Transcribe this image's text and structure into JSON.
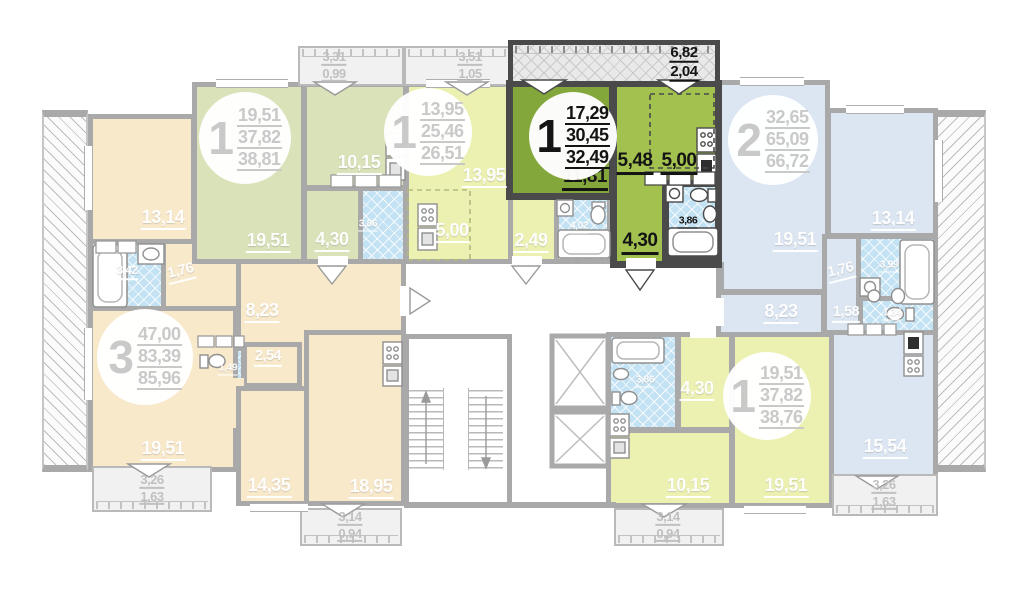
{
  "colors": {
    "selected_fill_dark": "#84a73c",
    "selected_fill_light": "#a3c14f",
    "selected_wall": "#4a4a4a",
    "wall": "#a9a9a9",
    "orange_fill": "#f9e9cb",
    "green_fill": "#d9e2b8",
    "lime_fill": "#ecf1b2",
    "blue_fill": "#dce6f3",
    "tile_fill": "#c3e2f3"
  },
  "apartments": [
    {
      "id": "apt-3-left",
      "number": "3",
      "selected": false,
      "areas": [
        "47,00",
        "83,39",
        "85,96"
      ],
      "rooms": {
        "r13": "13,14",
        "bath": "3,42",
        "c176": "1,76",
        "hall": "8,23",
        "wc": "1,49",
        "r254": "2,54",
        "r19": "19,51",
        "r14": "14,35",
        "r18": "18,95"
      },
      "balconies": [
        {
          "a": "3,26",
          "b": "1,63"
        },
        {
          "a": "3,14",
          "b": "0,94"
        }
      ]
    },
    {
      "id": "apt-1-top-left",
      "number": "1",
      "selected": false,
      "areas": [
        "19,51",
        "37,82",
        "38,81"
      ],
      "rooms": {
        "r19": "19,51",
        "k1015": "10,15",
        "h430": "4,30",
        "bath": "3,86"
      },
      "balconies": [
        {
          "a": "3,31",
          "b": "0,99"
        }
      ]
    },
    {
      "id": "apt-1-top-middle",
      "number": "1",
      "selected": false,
      "areas": [
        "13,95",
        "25,46",
        "26,51"
      ],
      "rooms": {
        "r1395": "13,95",
        "k500": "5,00",
        "h249": "2,49",
        "bath": "4,02"
      },
      "balconies": [
        {
          "a": "3,51",
          "b": "1,05"
        }
      ]
    },
    {
      "id": "apt-1-selected",
      "number": "1",
      "selected": true,
      "areas": [
        "17,29",
        "30,45",
        "32,49"
      ],
      "rooms": {
        "r1181": "11,81",
        "h548": "5,48",
        "k500": "5,00",
        "bath": "3,86",
        "h430": "4,30"
      },
      "balconies": [
        {
          "a": "6,82",
          "b": "2,04"
        }
      ]
    },
    {
      "id": "apt-2-right",
      "number": "2",
      "selected": false,
      "areas": [
        "32,65",
        "65,09",
        "66,72"
      ],
      "rooms": {
        "r19": "19,51",
        "r13": "13,14",
        "c176": "1,76",
        "bath": "3,99",
        "c158": "1,58",
        "wc": "1,34",
        "hall": "8,23",
        "k1554": "15,54"
      },
      "balconies": [
        {
          "a": "3,26",
          "b": "1,63"
        }
      ]
    },
    {
      "id": "apt-1-bottom-right",
      "number": "1",
      "selected": false,
      "areas": [
        "19,51",
        "37,82",
        "38,76"
      ],
      "rooms": {
        "bath": "3,86",
        "h430": "4,30",
        "k1015": "10,15",
        "r19": "19,51"
      },
      "balconies": [
        {
          "a": "3,14",
          "b": "0,94"
        }
      ]
    }
  ]
}
